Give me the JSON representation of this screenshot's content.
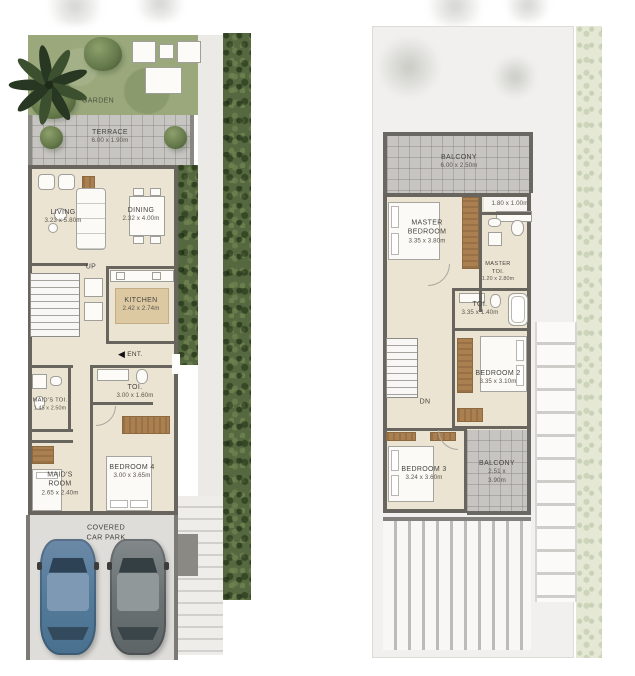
{
  "ground_floor": {
    "garden_label": "GARDEN",
    "terrace": {
      "label": "TERRACE",
      "dims": "6.00 x 1.90m"
    },
    "living": {
      "label": "LIVING",
      "dims": "3.23 x 5.80m"
    },
    "dining": {
      "label": "DINING",
      "dims": "2.32 x 4.00m"
    },
    "kitchen": {
      "label": "KITCHEN",
      "dims": "2.42 x 2.74m"
    },
    "stairs_label": "UP",
    "entrance_label": "ENT.",
    "maids_toi": {
      "label": "MAID'S TOI.",
      "dims": "1.45 x 2.50m"
    },
    "toi": {
      "label": "TOI.",
      "dims": "3.00 x 1.60m"
    },
    "maids_room": {
      "label": "MAID'S ROOM",
      "dims": "2.65 x 2.40m"
    },
    "bedroom4": {
      "label": "BEDROOM 4",
      "dims": "3.00 x 3.65m"
    },
    "car_park_label": "COVERED CAR PARK"
  },
  "first_floor": {
    "balcony_front": {
      "label": "BALCONY",
      "dims": "6.00 x 2.50m"
    },
    "window_dims": "1.80 x 1.00m",
    "master_bedroom": {
      "label": "MASTER BEDROOM",
      "dims": "3.35 x 3.80m"
    },
    "master_toi": {
      "label": "MASTER TOI.",
      "dims": "1.20 x 2.80m"
    },
    "toi": {
      "label": "TOI.",
      "dims": "3.35 x 1.40m"
    },
    "bedroom2": {
      "label": "BEDROOM 2",
      "dims": "3.35 x 3.10m"
    },
    "stairs_label": "DN",
    "bedroom3": {
      "label": "BEDROOM 3",
      "dims": "3.24 x 3.60m"
    },
    "balcony_rear": {
      "label": "BALCONY",
      "dims": "2.51 x 3.90m"
    }
  },
  "icons": {
    "entrance_arrow": "◀"
  },
  "colors": {
    "wall": "#67655e",
    "interior_floor": "#ece4d3",
    "terrace_grid": "#c7c5c1",
    "garden": "#9aa87b",
    "hedge": "#55683f",
    "car_blue": "#567c9c",
    "car_gray": "#6d7476"
  }
}
